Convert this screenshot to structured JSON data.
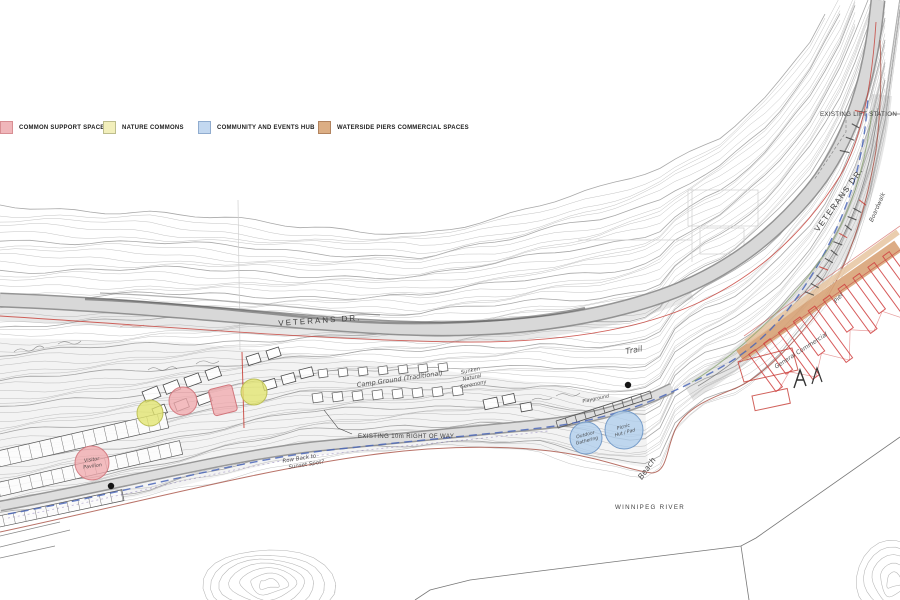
{
  "legend": {
    "items": [
      {
        "id": "common-support-spaces",
        "label": "COMMON SUPPORT SPACES",
        "color": "#f0b6ba",
        "border": "#d88e93"
      },
      {
        "id": "nature-commons",
        "label": "NATURE COMMONS",
        "color": "#f2efbb",
        "border": "#bdbd8d"
      },
      {
        "id": "community-events-hub",
        "label": "COMMUNITY AND EVENTS HUB",
        "color": "#c3d8f0",
        "border": "#90accf"
      },
      {
        "id": "waterside-piers-commercial",
        "label": "WATERSIDE PIERS COMMERCIAL SPACES",
        "color": "#dcae84",
        "border": "#b2835e"
      }
    ]
  },
  "labels": {
    "existing_lift_station": "EXISTING LIFT STATION",
    "veterans_dr_mid": "VETERANS DR.",
    "veterans_dr_right": "VETERANS DR.",
    "existing_right_of_way": "EXISTING 10m RIGHT OF WAY",
    "winnipeg_river": "WINNIPEG RIVER"
  },
  "handwritten": {
    "trail": "Trail",
    "beach": "Beach",
    "camp_ground": "Camp Ground (Traditional)",
    "ceremony_l1": "Sunken",
    "ceremony_l2": "Natural",
    "ceremony_l3": "Ceremony",
    "gathering_l1": "Outdoor",
    "gathering_l2": "Gathering",
    "hut_l1": "Picnic",
    "hut_l2": "Hut / Pad",
    "pavilion_l1": "Visitor",
    "pavilion_l2": "Pavilion",
    "rowback_l1": "Row Back to",
    "rowback_l2": "Sunset Spot?",
    "playground": "Playground",
    "boardwalk": "Boardwalk",
    "pier": "Pier",
    "commercial": "General Commercial"
  },
  "colors": {
    "contour": "#bdbdbd",
    "contour_index": "#9e9e9e",
    "road_fill": "#d8d8d8",
    "road_edge": "#8a8a8a",
    "boundary_red": "#c63b33",
    "shore_red": "#a85043",
    "trail_blue": "#4a66b8",
    "utility_green": "#86a26b",
    "pier_band": "#d8a377",
    "pier_band_light": "#e6c4a0",
    "pier_red": "#d04040",
    "bubble_pink": "#efa9ad",
    "bubble_pink_border": "#d1767c",
    "bubble_yellow": "#e2e46e",
    "bubble_yellow_border": "#b8bb4e",
    "bubble_blue": "#aecdec",
    "bubble_blue_border": "#6a93c4",
    "ink": "#3a3a3a"
  }
}
